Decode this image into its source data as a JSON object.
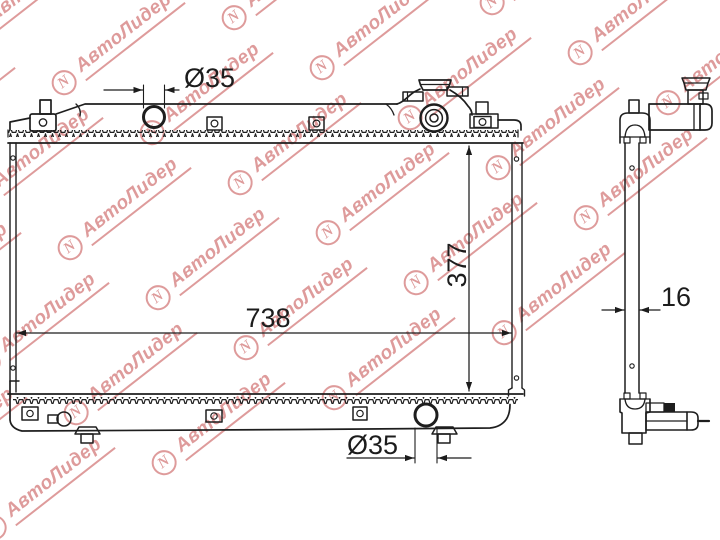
{
  "watermark": {
    "text": "АвтоЛидер",
    "logo_glyph": "N",
    "color": "#c75454",
    "angle_deg": -38,
    "lattice": {
      "origin": [
        60,
        242
      ],
      "v1": [
        170,
        -65
      ],
      "v2": [
        -82,
        115
      ],
      "i_range": [
        -2,
        4
      ],
      "j_range": [
        -3,
        3
      ]
    }
  },
  "drawing": {
    "subject": "radiator-technical-drawing",
    "line_color": "#1e1e1e",
    "dimensions": {
      "top_pipe_diameter": "Ø35",
      "core_height": "377",
      "core_width": "738",
      "side_depth": "16",
      "bottom_pipe_diameter": "Ø35"
    }
  }
}
